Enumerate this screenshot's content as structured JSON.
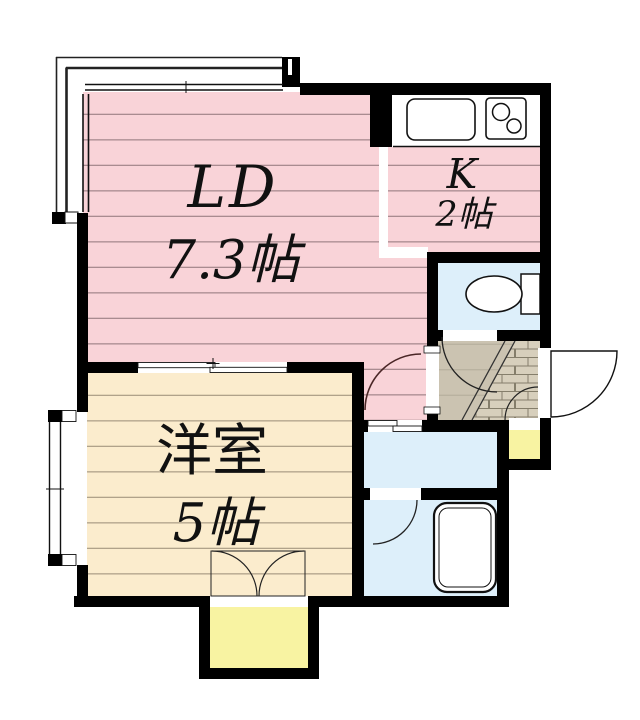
{
  "plan": {
    "rooms": {
      "living_dining": {
        "label": "LD",
        "size": "7.3帖"
      },
      "kitchen": {
        "label": "K",
        "size": "2帖"
      },
      "western_room": {
        "label": "洋室",
        "size": "5帖"
      }
    }
  },
  "colors": {
    "wall": "#000000",
    "living_floor": "#f9d3d8",
    "living_line": "#a98b90",
    "western_floor": "#fbeccd",
    "western_line": "#b0a28a",
    "wet_floor": "#ddeffa",
    "hall_floor": "#cbc3b1",
    "hall_line": "#b5ae9b",
    "tile_floor": "#d7cfbc",
    "tile_line": "#857e6b",
    "porch": "#f8f3a2",
    "fixture_stroke": "#1a1a1a",
    "door_arc": "#4a2626"
  }
}
